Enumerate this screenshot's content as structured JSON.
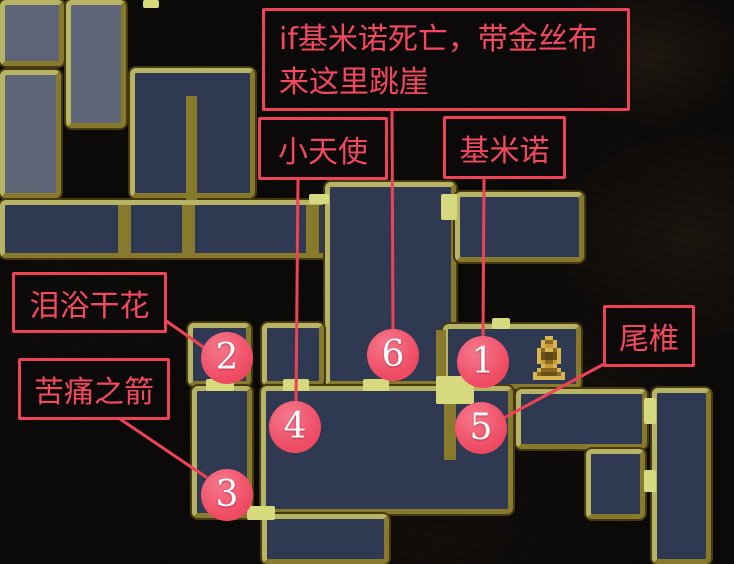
{
  "palette": {
    "background": "#0c0a09",
    "room_navy": "#2f3a52",
    "room_light": "#5d6577",
    "wall_bright": "#d6d97e",
    "wall_bright2": "#b7b565",
    "wall_dark": "#877a2d",
    "wall_shadow": "#453a12",
    "accent_red": "#ee4257",
    "text_red": "#f2495e",
    "marker_fill": "#ee4a62",
    "marker_text": "#ffffff",
    "player_gold": "#d8b554"
  },
  "annotations": {
    "top_note": {
      "line1": "if基米诺死亡，带金丝布",
      "line2": "来这里跳崖"
    },
    "labels": {
      "little_angel": "小天使",
      "jiminuo": "基米诺",
      "tear_flower": "泪浴干花",
      "pain_arrow": "苦痛之箭",
      "tailbone": "尾椎"
    }
  },
  "markers": [
    {
      "number": "1",
      "cx": 483,
      "cy": 362
    },
    {
      "number": "2",
      "cx": 227,
      "cy": 358
    },
    {
      "number": "3",
      "cx": 227,
      "cy": 495
    },
    {
      "number": "4",
      "cx": 295,
      "cy": 427
    },
    {
      "number": "5",
      "cx": 481,
      "cy": 428
    },
    {
      "number": "6",
      "cx": 393,
      "cy": 355
    }
  ],
  "map": {
    "player_icon": {
      "name": "player-statue-icon",
      "x": 533,
      "y": 336
    },
    "rooms": [
      {
        "kind": "l",
        "x": 0,
        "y": 0,
        "w": 64,
        "h": 66
      },
      {
        "kind": "l",
        "x": 66,
        "y": 0,
        "w": 60,
        "h": 128
      },
      {
        "kind": "l",
        "x": 0,
        "y": 70,
        "w": 61,
        "h": 128
      },
      {
        "kind": "n",
        "x": 130,
        "y": 68,
        "w": 125,
        "h": 130
      },
      {
        "kind": "n",
        "x": 0,
        "y": 200,
        "w": 332,
        "h": 58
      },
      {
        "kind": "n",
        "x": 325,
        "y": 182,
        "w": 131,
        "h": 204
      },
      {
        "kind": "n",
        "x": 455,
        "y": 192,
        "w": 129,
        "h": 70
      },
      {
        "kind": "n",
        "x": 188,
        "y": 323,
        "w": 63,
        "h": 63
      },
      {
        "kind": "n",
        "x": 262,
        "y": 323,
        "w": 62,
        "h": 63
      },
      {
        "kind": "n",
        "x": 443,
        "y": 324,
        "w": 138,
        "h": 65
      },
      {
        "kind": "n",
        "x": 192,
        "y": 386,
        "w": 60,
        "h": 132
      },
      {
        "kind": "n",
        "x": 261,
        "y": 386,
        "w": 252,
        "h": 128
      },
      {
        "kind": "n",
        "x": 516,
        "y": 389,
        "w": 131,
        "h": 60
      },
      {
        "kind": "n",
        "x": 652,
        "y": 388,
        "w": 59,
        "h": 176
      },
      {
        "kind": "n",
        "x": 586,
        "y": 449,
        "w": 59,
        "h": 70
      },
      {
        "kind": "n",
        "x": 262,
        "y": 514,
        "w": 127,
        "h": 50
      },
      {
        "kind": "d",
        "x": 186,
        "y": 96,
        "w": 11,
        "h": 104
      },
      {
        "kind": "d",
        "x": 118,
        "y": 205,
        "w": 13,
        "h": 48
      },
      {
        "kind": "d",
        "x": 182,
        "y": 205,
        "w": 13,
        "h": 48
      },
      {
        "kind": "d",
        "x": 306,
        "y": 205,
        "w": 13,
        "h": 48
      },
      {
        "kind": "d",
        "x": 436,
        "y": 330,
        "w": 10,
        "h": 50
      },
      {
        "kind": "d",
        "x": 444,
        "y": 394,
        "w": 12,
        "h": 66
      },
      {
        "kind": "b",
        "x": 143,
        "y": 0,
        "w": 16,
        "h": 8
      },
      {
        "kind": "b",
        "x": 309,
        "y": 194,
        "w": 20,
        "h": 10
      },
      {
        "kind": "b",
        "x": 441,
        "y": 194,
        "w": 16,
        "h": 26
      },
      {
        "kind": "b",
        "x": 492,
        "y": 318,
        "w": 18,
        "h": 11
      },
      {
        "kind": "b",
        "x": 436,
        "y": 376,
        "w": 38,
        "h": 28
      },
      {
        "kind": "b",
        "x": 206,
        "y": 379,
        "w": 28,
        "h": 12
      },
      {
        "kind": "b",
        "x": 283,
        "y": 379,
        "w": 26,
        "h": 12
      },
      {
        "kind": "b",
        "x": 363,
        "y": 379,
        "w": 26,
        "h": 12
      },
      {
        "kind": "b",
        "x": 644,
        "y": 398,
        "w": 12,
        "h": 26
      },
      {
        "kind": "b",
        "x": 644,
        "y": 470,
        "w": 12,
        "h": 22
      },
      {
        "kind": "b",
        "x": 247,
        "y": 506,
        "w": 28,
        "h": 14
      }
    ],
    "leader_lines": [
      {
        "x1": 392,
        "y1": 111,
        "x2": 393,
        "y2": 333
      },
      {
        "x1": 298,
        "y1": 180,
        "x2": 296,
        "y2": 403
      },
      {
        "x1": 484,
        "y1": 180,
        "x2": 483,
        "y2": 339
      },
      {
        "x1": 165,
        "y1": 320,
        "x2": 206,
        "y2": 349
      },
      {
        "x1": 120,
        "y1": 419,
        "x2": 206,
        "y2": 477
      },
      {
        "x1": 604,
        "y1": 364,
        "x2": 500,
        "y2": 420
      }
    ]
  }
}
